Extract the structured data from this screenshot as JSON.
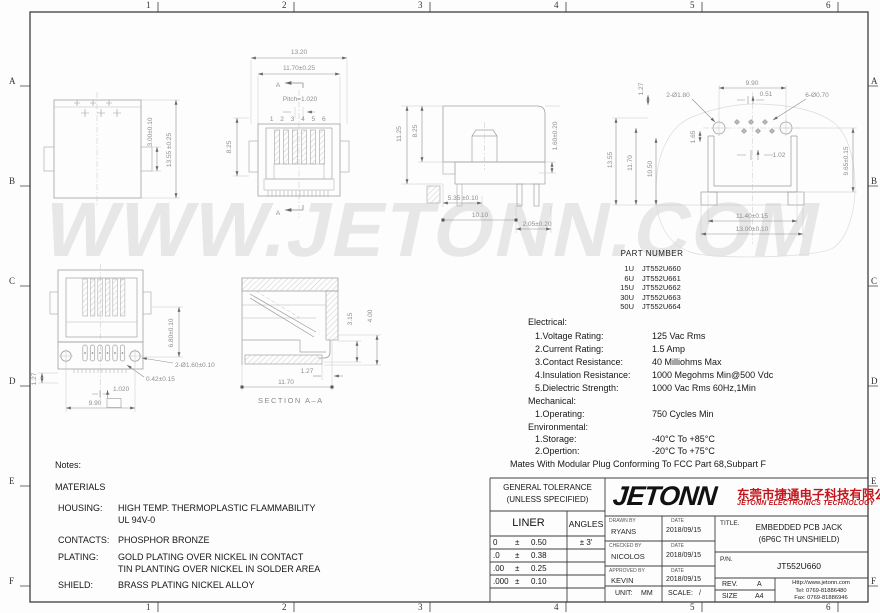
{
  "colors": {
    "brand_red": "#c3161c",
    "line_gray": "#a0a0a0",
    "dim_gray": "#8e8e8e"
  },
  "watermark": "WWW.JETONN.COM",
  "grid": {
    "cols": [
      "1",
      "2",
      "3",
      "4",
      "5",
      "6"
    ],
    "rows": [
      "A",
      "B",
      "C",
      "D",
      "E",
      "F"
    ]
  },
  "views": {
    "top": {
      "dim_3_00": "3.00±0.10",
      "dim_13_55": "13.55 ±0.25"
    },
    "front": {
      "dim_13_20": "13.20",
      "dim_11_70": "11.70±0.25",
      "section_mark": "A",
      "pitch": "Pitch=1.020",
      "pins": "1 2 3 4 5 6",
      "dim_8_25": "8.25"
    },
    "side": {
      "dim_11_25": "11.25",
      "dim_8_25": "8.25",
      "dim_1_60": "1.60±0.20",
      "dim_5_35": "5.35 ±0.10",
      "dim_10_10": "10.10",
      "dim_2_05": "2.05±0.20"
    },
    "footprint": {
      "dim_9_90": "9.90",
      "dim_0_51": "0.51",
      "holes_large": "2-Ø1.80",
      "holes_small": "6-Ø0.70",
      "dim_1_27": "1.27",
      "dim_1_65": "1.65",
      "dim_1_02": "1.02",
      "dim_13_55": "13.55",
      "dim_11_70": "11.70",
      "dim_10_50": "10.50",
      "dim_9_65": "9.65±0.15",
      "dim_11_40": "11.40±0.15",
      "dim_13_00": "13.00±0.10"
    },
    "bottom": {
      "dim_1_27": "1.27",
      "dim_6_80": "6.80±0.10",
      "holes": "2-Ø1.60±0.10",
      "dim_0_42": "0.42±0.15",
      "pitch": "1.020",
      "dim_9_90": "9.90"
    },
    "section": {
      "dim_3_15": "3.15",
      "dim_4_00": "4.00",
      "dim_1_27": "1.27",
      "dim_11_70": "11.70",
      "label": "SECTION A–A"
    }
  },
  "part_table": {
    "title": "PART NUMBER",
    "rows": [
      {
        "qty": "1U",
        "pn": "JT552U660"
      },
      {
        "qty": "6U",
        "pn": "JT552U661"
      },
      {
        "qty": "15U",
        "pn": "JT552U662"
      },
      {
        "qty": "30U",
        "pn": "JT552U663"
      },
      {
        "qty": "50U",
        "pn": "JT552U664"
      }
    ]
  },
  "specs": {
    "electrical_heading": "Electrical:",
    "electrical": [
      [
        "1.Voltage Rating:",
        "125 Vac Rms"
      ],
      [
        "2.Current Rating:",
        "1.5 Amp"
      ],
      [
        "3.Contact Resistance:",
        "40 Milliohms Max"
      ],
      [
        "4.Insulation Resistance:",
        "1000 Megohms Min@500 Vdc"
      ],
      [
        "5.Dielectric Strength:",
        "1000 Vac Rms 60Hz,1Min"
      ]
    ],
    "mechanical_heading": "Mechanical:",
    "mechanical": [
      [
        "1.Operating:",
        "750 Cycles Min"
      ]
    ],
    "environmental_heading": "Environmental:",
    "environmental": [
      [
        "1.Storage:",
        "-40°C To +85°C"
      ],
      [
        "2.Opertion:",
        "-20°C To +75°C"
      ]
    ],
    "footnote": "Mates With Modular Plug Conforming To FCC Part 68,Subpart F"
  },
  "notes": {
    "heading": "Notes:",
    "materials_heading": "MATERIALS",
    "housing_label": "HOUSING:",
    "housing_value_1": "HIGH TEMP. THERMOPLASTIC FLAMMABILITY",
    "housing_value_2": "UL 94V-0",
    "contacts_label": "CONTACTS:",
    "contacts_value": "PHOSPHOR BRONZE",
    "plating_label": "PLATING:",
    "plating_value_1": "GOLD PLATING OVER NICKEL IN CONTACT",
    "plating_value_2": "TIN PLANTING OVER NICKEL IN SOLDER AREA",
    "shield_label": "SHIELD:",
    "shield_value": "BRASS PLATING NICKEL ALLOY"
  },
  "title_block": {
    "general_tolerance_line1": "GENERAL TOLERANCE",
    "general_tolerance_line2": "(UNLESS SPECIFIED)",
    "liner_header": "LINER",
    "angles_header": "ANGLES",
    "angles_value": "± 3'",
    "tol_rows": [
      {
        "digits": "0",
        "pm": "±",
        "val": "0.50"
      },
      {
        "digits": ".0",
        "pm": "±",
        "val": "0.38"
      },
      {
        "digits": ".00",
        "pm": "±",
        "val": "0.25"
      },
      {
        "digits": ".000",
        "pm": "±",
        "val": "0.10"
      }
    ],
    "logo_text": "JETONN",
    "company_cn": "东莞市捷通电子科技有限公司",
    "company_en": "JETONN ELECTRONICS TECHNOLOGY",
    "drawn_by_label": "DRAWN BY",
    "drawn_by": "RYANS",
    "date_label": "DATE",
    "drawn_date": "2018/09/15",
    "checked_by_label": "CHECKED BY",
    "checked_by": "NICOLOS",
    "checked_date": "2018/09/15",
    "approved_by_label": "APPROVED BY",
    "approved_by": "KEVIN",
    "approved_date": "2018/09/15",
    "unit_label": "UNIT:",
    "unit": "MM",
    "scale_label": "SCALE:",
    "scale": "/",
    "title_label": "TITLE.",
    "title_line1": "EMBEDDED PCB JACK",
    "title_line2": "(6P6C TH UNSHIELD)",
    "pn_label": "P/N.",
    "pn": "JT552U660",
    "rev_label": "REV.",
    "rev": "A",
    "size_label": "SIZE",
    "size": "A4",
    "website": "Http://www.jetonn.com",
    "tel": "Tel: 0769-81886480",
    "fax": "Fax: 0769-81886946"
  }
}
